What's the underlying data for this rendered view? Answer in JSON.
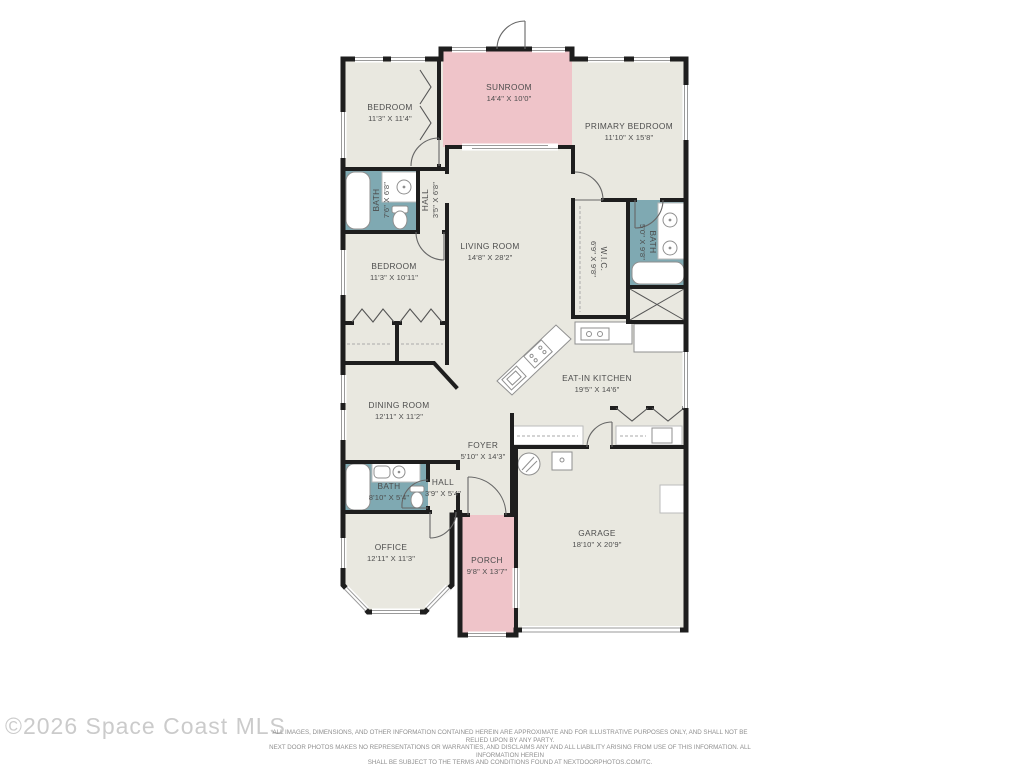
{
  "title": "Residential floor plan",
  "colors": {
    "room_fill": "#e9e8e0",
    "sunroom_fill": "#efc4c9",
    "bath_fill": "#7fa9b2",
    "wall": "#1e1e1e",
    "label_text": "#4d4d4d",
    "copyright_text": "#cbcbcb",
    "disclaimer_text": "#8f8f8f"
  },
  "rooms": {
    "bedroom1": {
      "name": "BEDROOM",
      "dims": "11'3\" X 11'4\""
    },
    "sunroom": {
      "name": "SUNROOM",
      "dims": "14'4\" X 10'0\""
    },
    "primary_bedroom": {
      "name": "PRIMARY BEDROOM",
      "dims": "11'10\" X 15'8\""
    },
    "bath1": {
      "name": "BATH",
      "dims": "7'6\" X 6'8\""
    },
    "hall1": {
      "name": "HALL",
      "dims": "3'5\" X 6'8\""
    },
    "living_room": {
      "name": "LIVING ROOM",
      "dims": "14'8\" X 28'2\""
    },
    "wic": {
      "name": "W.I.C.",
      "dims": "6'9\" X 9'8\""
    },
    "bath2": {
      "name": "BATH",
      "dims": "5'0\" X 9'8\""
    },
    "bedroom2": {
      "name": "BEDROOM",
      "dims": "11'3\" X 10'11\""
    },
    "dining_room": {
      "name": "DINING ROOM",
      "dims": "12'11\" X 11'2\""
    },
    "kitchen": {
      "name": "EAT-IN KITCHEN",
      "dims": "19'5\" X 14'6\""
    },
    "foyer": {
      "name": "FOYER",
      "dims": "5'10\" X 14'3\""
    },
    "hall2": {
      "name": "HALL",
      "dims": "3'9\" X 5'4\""
    },
    "bath3": {
      "name": "BATH",
      "dims": "8'10\" X 5'4\""
    },
    "office": {
      "name": "OFFICE",
      "dims": "12'11\" X 11'3\""
    },
    "porch": {
      "name": "PORCH",
      "dims": "9'8\" X 13'7\""
    },
    "garage": {
      "name": "GARAGE",
      "dims": "18'10\" X 20'9\""
    }
  },
  "footer": {
    "copyright": "©2026 Space Coast MLS",
    "disclaimer_line1": "ALL IMAGES, DIMENSIONS, AND OTHER INFORMATION CONTAINED HEREIN ARE APPROXIMATE AND FOR ILLUSTRATIVE PURPOSES ONLY, AND SHALL NOT BE RELIED UPON BY ANY PARTY.",
    "disclaimer_line2": "NEXT DOOR PHOTOS MAKES NO REPRESENTATIONS OR WARRANTIES, AND DISCLAIMS ANY AND ALL LIABILITY ARISING FROM USE OF THIS INFORMATION. ALL INFORMATION HEREIN",
    "disclaimer_line3": "SHALL BE SUBJECT TO THE TERMS AND CONDITIONS FOUND AT NEXTDOORPHOTOS.COM/TC."
  }
}
